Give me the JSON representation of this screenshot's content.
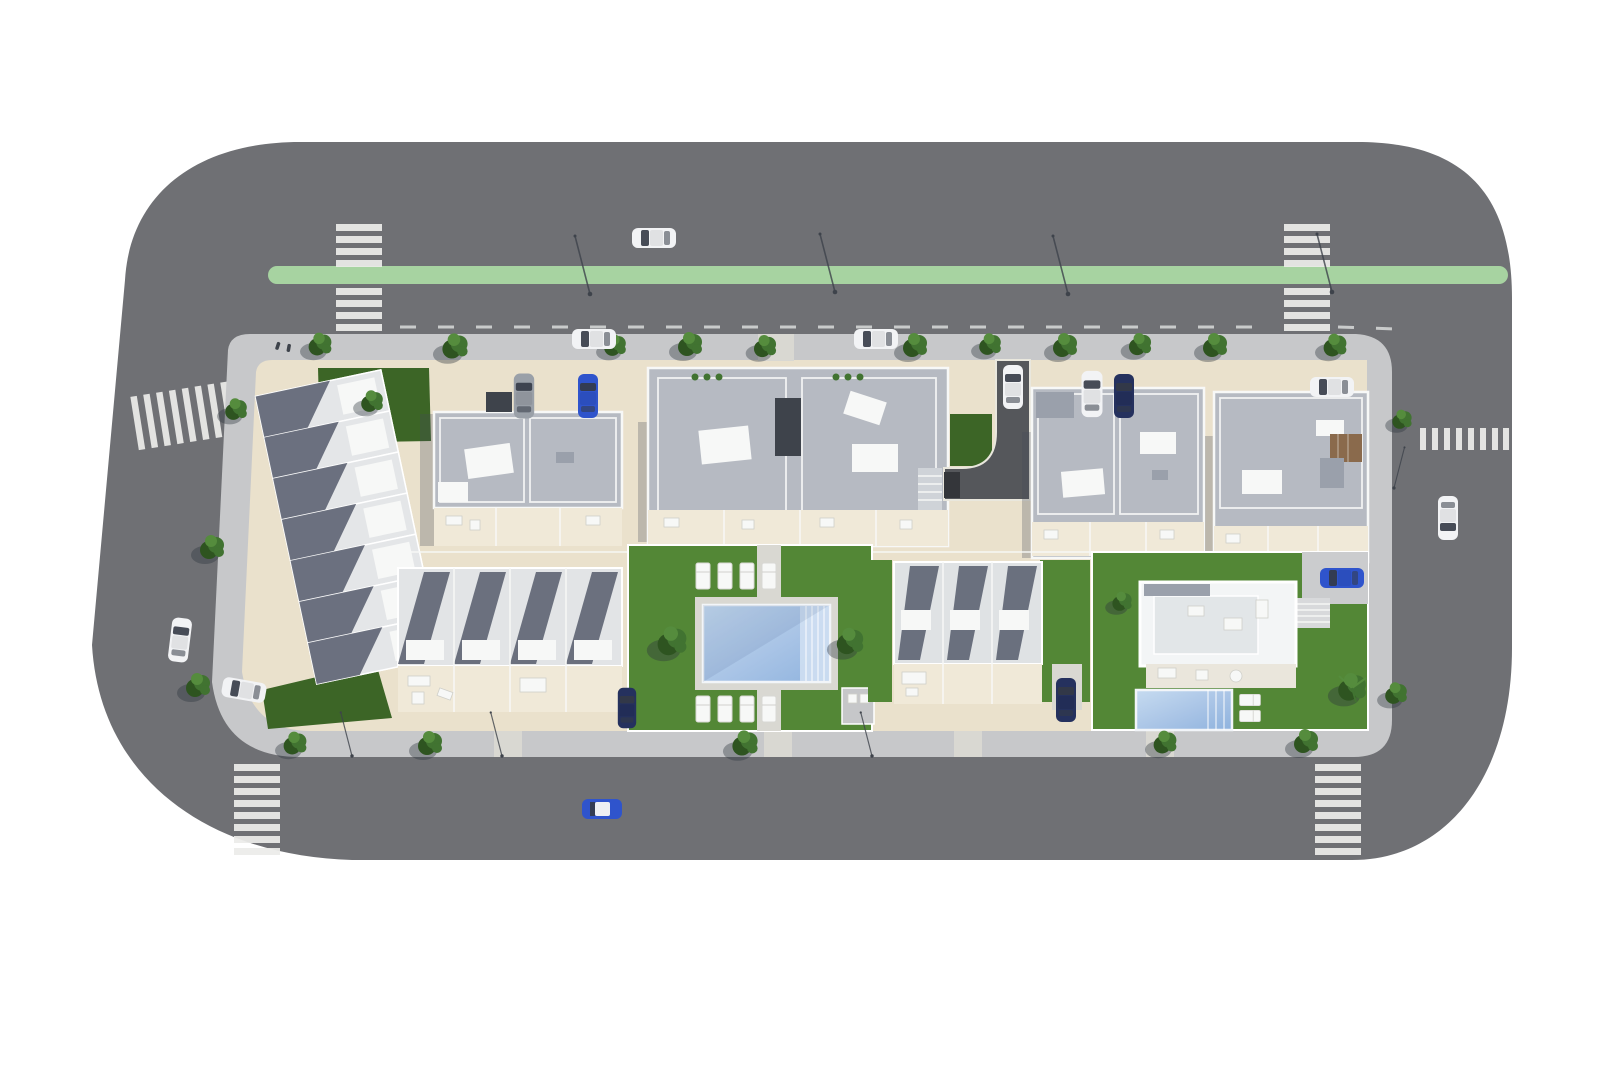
{
  "meta": {
    "title": "Aerial 3D site-plan render of a residential development block",
    "view": "top-down bird's-eye",
    "background": "#ffffff"
  },
  "colors": {
    "road": "#6f7074",
    "sidewalk": "#c7c8ca",
    "curb": "#e9e7dd",
    "plot": "#eae1cc",
    "terrace": "#f0e9d8",
    "stripe": "#ececea",
    "bikeLane": "#a7d3a1",
    "dashLine": "#d9dadb",
    "roofGray": "#b6bac2",
    "roofPanel": "#9aa0ab",
    "roofWhite": "#f7f8f7",
    "unitShadow": "#5a6070",
    "softShadow": "rgba(70,76,90,0.28)",
    "lawn": "#538736",
    "lawnDark": "#3c6526",
    "deck": "#d9d8d2",
    "poolLight": "#c2d8ee",
    "poolMid": "#a9c4e6",
    "poolDark": "#8fb3de",
    "poolStep": "#cfdff2",
    "carWhite": "#f2f3f5",
    "carBlue": "#2f54cc",
    "carNavy": "#25315e",
    "carGray": "#9aa0a8",
    "windowGlass": "#343a46",
    "treeDark": "#2e5420",
    "treeMid": "#417331",
    "treeLight": "#558c3d",
    "treeShadow": "rgba(45,52,60,0.38)",
    "metalDark": "#3e434b",
    "brown": "#8a6a4c",
    "ramp": "#55575b"
  },
  "site": {
    "roads": {
      "surface": "asphalt ring road with rounded corners",
      "bike_lane": {
        "orientation": "horizontal, top road",
        "rounded_left_cap": true
      },
      "crosswalks": [
        {
          "id": "crosswalk-top-left",
          "orientation": "vertical"
        },
        {
          "id": "crosswalk-top-right",
          "orientation": "vertical"
        },
        {
          "id": "crosswalk-left",
          "orientation": "horizontal, slightly skewed"
        },
        {
          "id": "crosswalk-right",
          "orientation": "horizontal"
        },
        {
          "id": "crosswalk-bottom-left",
          "orientation": "vertical"
        },
        {
          "id": "crosswalk-bottom-right",
          "orientation": "vertical"
        }
      ],
      "lane_marking": "dashed white centre line on top road",
      "streetlamps": 8
    },
    "block": {
      "buildings": [
        {
          "id": "townhouse-row-west",
          "type": "townhouses",
          "units": 7,
          "orientation": "diagonal"
        },
        {
          "id": "apartment-building-a",
          "type": "apartment block",
          "position": "top row 1"
        },
        {
          "id": "apartment-building-b",
          "type": "apartment block",
          "position": "top row 2 (largest)"
        },
        {
          "id": "apartment-building-c",
          "type": "apartment block",
          "position": "top row 3"
        },
        {
          "id": "apartment-building-d",
          "type": "apartment block",
          "position": "top row 4, wood deck"
        },
        {
          "id": "townhouse-row-south-a",
          "type": "townhouses",
          "units": 4
        },
        {
          "id": "townhouse-row-south-b",
          "type": "townhouses",
          "units": 3
        },
        {
          "id": "villa",
          "type": "detached villa",
          "features": [
            "private pool",
            "roof terrace",
            "palm tree",
            "garden"
          ]
        }
      ],
      "amenities": {
        "communal_pool": {
          "shape": "rectangular",
          "steps_side": "right",
          "sun_loungers": 8
        },
        "villa_loungers": 2,
        "central_path": "vertical paved path through pool garden",
        "garage_ramp": "curved asphalt ramp from top road"
      }
    },
    "vehicles": [
      {
        "id": "car-top-road",
        "color": "white",
        "state": "driving",
        "orientation": "horizontal"
      },
      {
        "id": "car-parked-top-1",
        "color": "white",
        "state": "parked",
        "orientation": "horizontal"
      },
      {
        "id": "car-parked-top-2",
        "color": "white",
        "state": "parked",
        "orientation": "horizontal"
      },
      {
        "id": "car-ramp",
        "color": "white",
        "state": "on garage ramp",
        "orientation": "vertical"
      },
      {
        "id": "van-building-a",
        "color": "gray",
        "state": "parked",
        "orientation": "vertical"
      },
      {
        "id": "car-building-a",
        "color": "blue",
        "state": "parked",
        "orientation": "vertical"
      },
      {
        "id": "van-building-c",
        "color": "white",
        "state": "parked",
        "orientation": "vertical"
      },
      {
        "id": "car-building-c",
        "color": "navy",
        "state": "parked",
        "orientation": "vertical"
      },
      {
        "id": "car-building-d",
        "color": "white",
        "state": "parked",
        "orientation": "horizontal"
      },
      {
        "id": "car-right-road",
        "color": "white",
        "state": "driving",
        "orientation": "vertical"
      },
      {
        "id": "car-left-road",
        "color": "white",
        "state": "parked",
        "orientation": "vertical"
      },
      {
        "id": "car-left-corner",
        "color": "white",
        "state": "parked",
        "orientation": "horizontal"
      },
      {
        "id": "car-bottom-road",
        "color": "blue with white roof",
        "state": "driving",
        "orientation": "horizontal"
      },
      {
        "id": "car-townhouse-south-a",
        "color": "navy",
        "state": "parked",
        "orientation": "vertical"
      },
      {
        "id": "car-townhouse-south-b",
        "color": "navy",
        "state": "parked",
        "orientation": "vertical"
      },
      {
        "id": "car-villa",
        "color": "blue",
        "state": "parked",
        "orientation": "horizontal"
      }
    ],
    "vegetation": {
      "street_trees": 21,
      "garden_bushes": 4,
      "palm_trees": 1,
      "lawn_patches": 5
    },
    "pedestrians": 2
  }
}
